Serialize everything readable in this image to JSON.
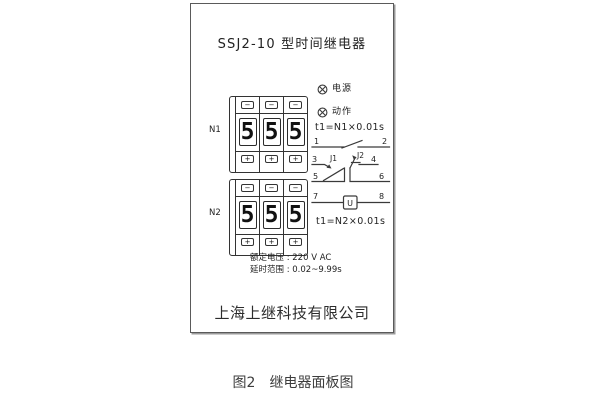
{
  "panel": {
    "title": "SSJ2-10 型时间继电器",
    "indicators": {
      "power": "电源",
      "action": "动作"
    },
    "formulas": {
      "n1": "t1=N1×0.01s",
      "n2": "t1=N2×0.01s"
    },
    "thumbwheel_n1": {
      "label": "N1",
      "digits": [
        "5",
        "5",
        "5"
      ]
    },
    "thumbwheel_n2": {
      "label": "N2",
      "digits": [
        "5",
        "5",
        "5"
      ]
    },
    "buttons": {
      "minus": "−",
      "plus": "+"
    },
    "schematic": {
      "terminals": [
        "1",
        "2",
        "3",
        "4",
        "5",
        "6",
        "7",
        "8"
      ],
      "contacts": {
        "j1": "J1",
        "j2": "J2"
      },
      "coil": "U"
    },
    "ratings": {
      "voltage": "额定电压 : 220 V AC",
      "delay_range": "延时范围 : 0.02~9.99s"
    },
    "manufacturer": "上海上继科技有限公司"
  },
  "caption": {
    "figure": "图2",
    "title": "继电器面板图"
  },
  "colors": {
    "line": "#3a3a3a",
    "text": "#222222",
    "background": "#ffffff"
  }
}
